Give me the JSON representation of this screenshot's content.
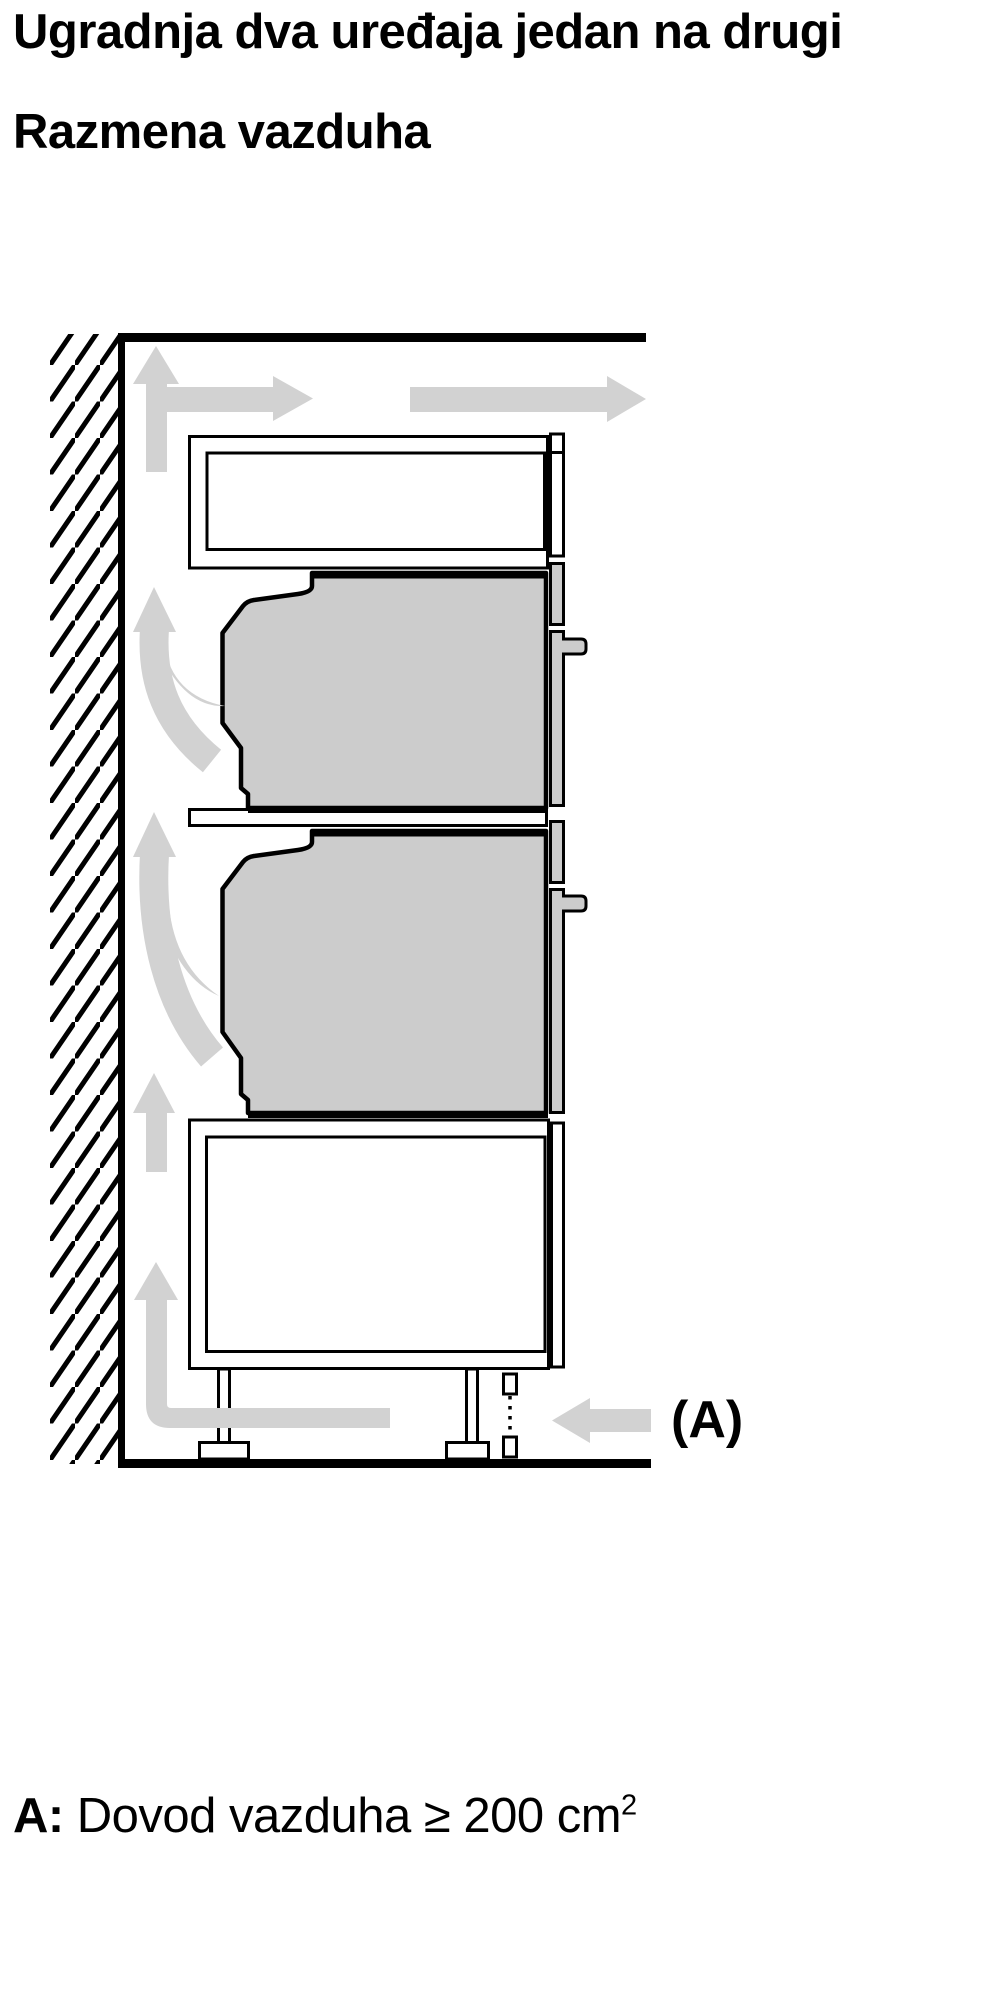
{
  "page": {
    "title_line_1": "Ugradnja dva uređaja jedan na drugi",
    "title_line_2": "Razmena vazduha"
  },
  "diagram": {
    "label_a": "(A)",
    "icons": {
      "wall-hatching-icon": "diagonal-hatch-wall-section",
      "airflow-up-arrow-icon": "up-arrow",
      "airflow-right-arrow-icon": "right-arrow",
      "airflow-curved-arrow-icon": "curved-up-swoosh-arrow",
      "airflow-inlet-arrow-icon": "left-arrow",
      "vent-cutout-marker-icon": "two-small-rectangles-with-dotted-line"
    },
    "colors": {
      "line": "#000000",
      "appliance_fill": "#cccccc",
      "arrow_fill": "#d2d2d2",
      "cabinet_fill": "#ffffff",
      "background": "#ffffff"
    }
  },
  "caption": {
    "prefix": "A:",
    "text": "Dovod vazduha ≥ 200 cm",
    "superscript": "2",
    "full_text": "A: Dovod vazduha ≥ 200 cm²"
  }
}
